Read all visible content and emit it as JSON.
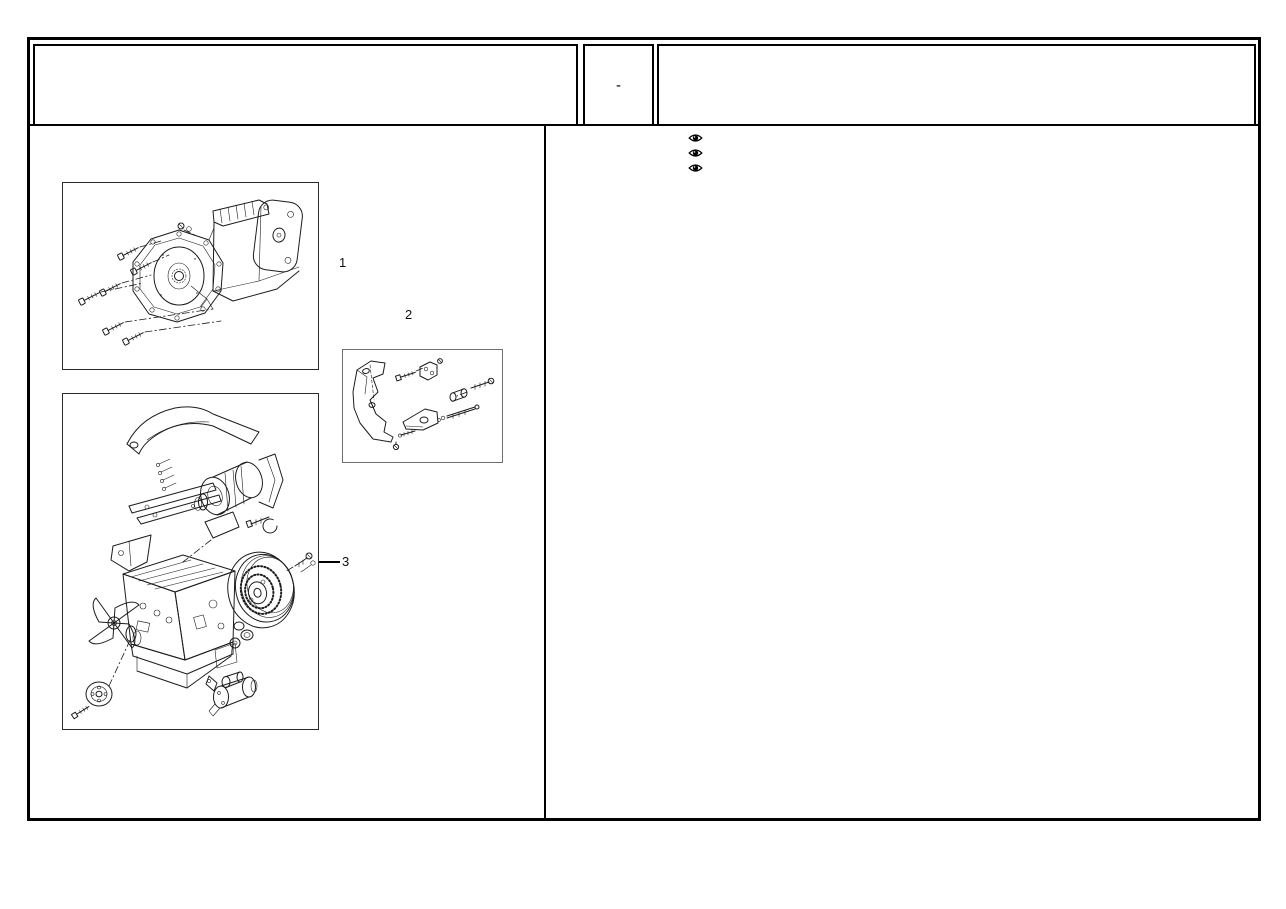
{
  "page": {
    "background": "#ffffff",
    "frame_color": "#000000"
  },
  "header": {
    "left_cell": {
      "text": ""
    },
    "code_cell": {
      "text": "-"
    },
    "title_cell": {
      "text": ""
    }
  },
  "visibility_toolbar": {
    "icons": [
      "eye-icon",
      "eye-icon",
      "eye-icon"
    ]
  },
  "figures": [
    {
      "label": "1",
      "name": "gearbox-exploded-view"
    },
    {
      "label": "2",
      "name": "engine-mount-bracket-exploded-view"
    },
    {
      "label": "3",
      "name": "engine-with-alternator-exploded-view"
    }
  ]
}
